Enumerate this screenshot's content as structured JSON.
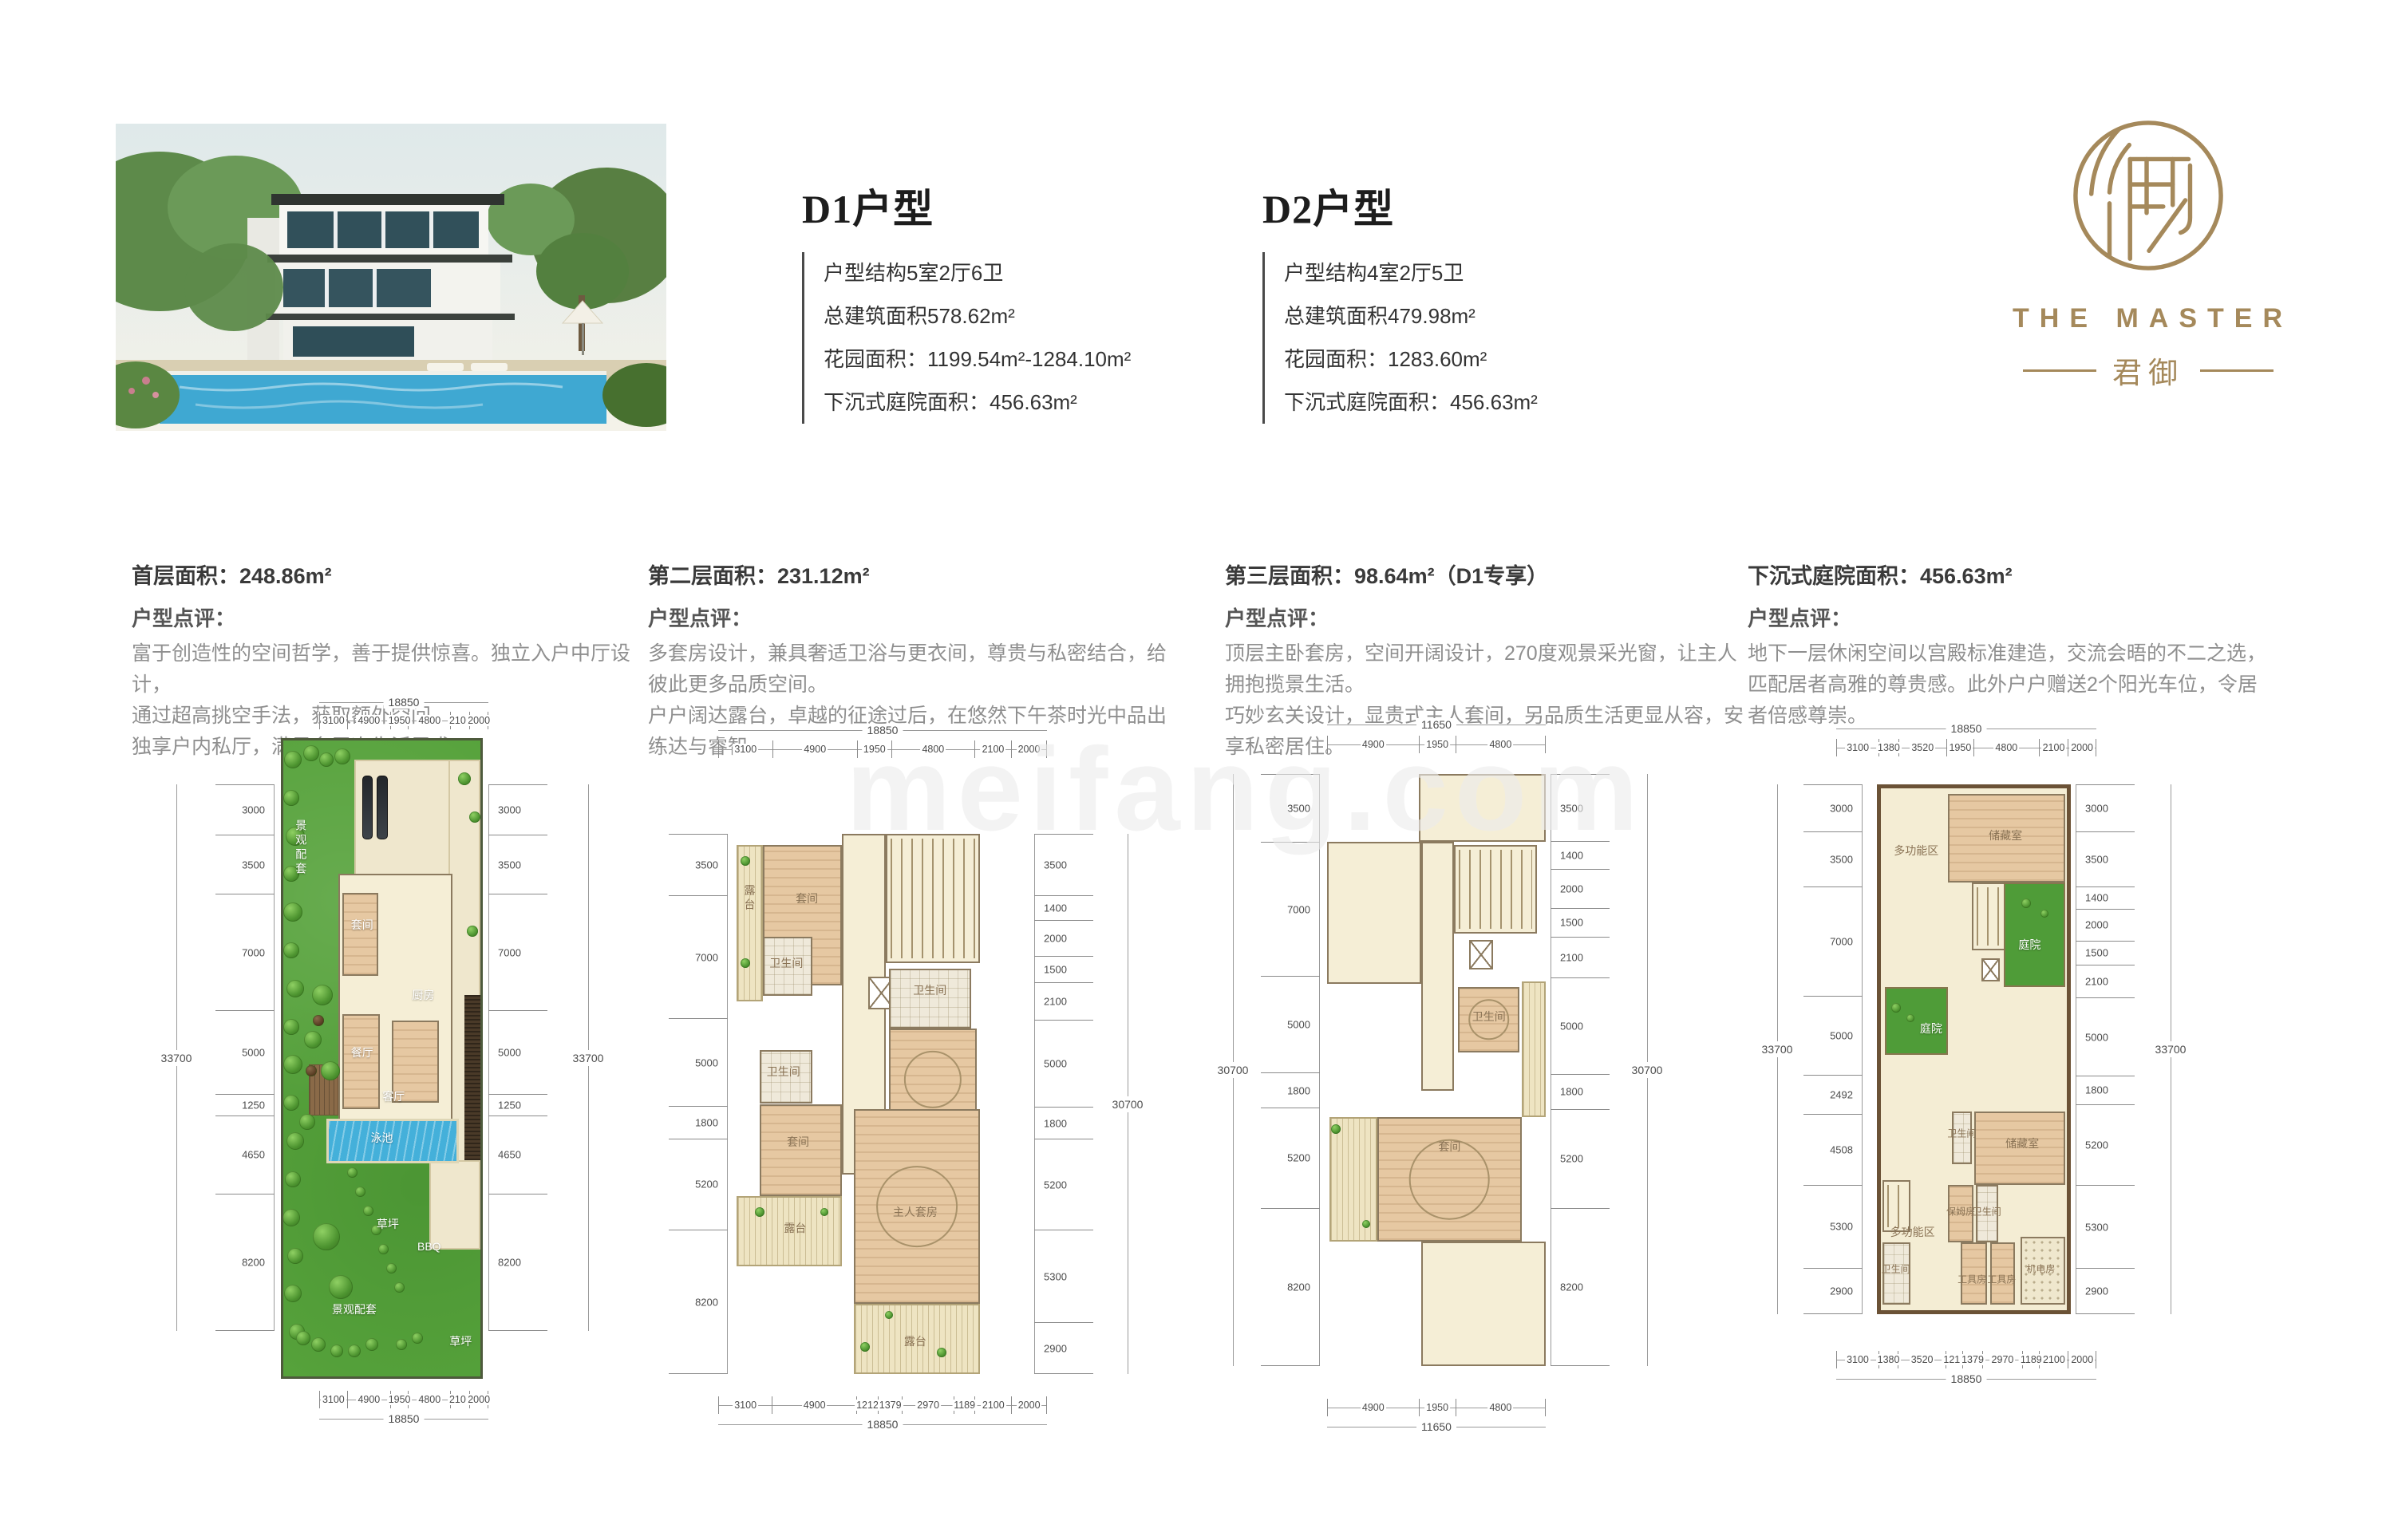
{
  "watermark": "meifang.com",
  "logo": {
    "name": "THE MASTER",
    "cn": "君御"
  },
  "units": [
    {
      "title": "D1户型",
      "lines": [
        "户型结构5室2厅6卫",
        "总建筑面积578.62m²",
        "花园面积：1199.54m²-1284.10m²",
        "下沉式庭院面积：456.63m²"
      ]
    },
    {
      "title": "D2户型",
      "lines": [
        "户型结构4室2厅5卫",
        "总建筑面积479.98m²",
        "花园面积：1283.60m²",
        "下沉式庭院面积：456.63m²"
      ]
    }
  ],
  "sections": [
    {
      "area": "首层面积：248.86m²",
      "comment_label": "户型点评：",
      "lines": [
        "富于创造性的空间哲学，善于提供惊喜。独立入户中厅设计，",
        "通过超高挑空手法，获取额外空间。",
        "独享户内私厅，满足多层次生活需求。"
      ]
    },
    {
      "area": "第二层面积：231.12m²",
      "comment_label": "户型点评：",
      "lines": [
        "多套房设计，兼具奢适卫浴与更衣间，尊贵与私密结合，给彼此更多品质空间。",
        "户户阔达露台，卓越的征途过后，在悠然下午茶时光中品出练达与睿智。"
      ]
    },
    {
      "area": "第三层面积：98.64m²（D1专享）",
      "comment_label": "户型点评：",
      "lines": [
        "顶层主卧套房，空间开阔设计，270度观景采光窗，让主人拥抱揽景生活。",
        "巧妙玄关设计，显贵式主人套间，另品质生活更显从容，安享私密居住。"
      ]
    },
    {
      "area": "下沉式庭院面积：456.63m²",
      "comment_label": "户型点评：",
      "lines": [
        "地下一层休闲空间以宫殿标准建造，交流会晤的不二之选，",
        "匹配居者高雅的尊贵感。此外户户赠送2个阳光车位，令居者倍感尊崇。"
      ]
    }
  ],
  "plans": [
    {
      "name": "首层",
      "top": {
        "total": "18850",
        "segments": [
          "3100",
          "4900",
          "1950",
          "4800",
          "2100",
          "2000"
        ]
      },
      "bottom": {
        "total": "18850",
        "segments": [
          "3100",
          "4900",
          "1950",
          "4800",
          "2100",
          "2000"
        ]
      },
      "left": {
        "total": "33700",
        "segments": [
          "3000",
          "3500",
          "7000",
          "5000",
          "1250",
          "4650",
          "8200"
        ]
      },
      "right": {
        "total": "33700",
        "segments": [
          "3000",
          "3500",
          "7000",
          "5000",
          "1250",
          "4650",
          "8200"
        ]
      },
      "rooms": [
        "景观配套",
        "套间",
        "厨房",
        "餐厅",
        "客厅",
        "泳池",
        "草坪",
        "BBQ",
        "景观配套",
        "草坪"
      ]
    },
    {
      "name": "第二层",
      "top": {
        "total": "18850",
        "segments": [
          "3100",
          "4900",
          "1950",
          "4800",
          "2100",
          "2000"
        ]
      },
      "bottom": {
        "total": "18850",
        "segments": [
          "3100",
          "4900",
          "1212",
          "1379",
          "2970",
          "1189",
          "2100",
          "2000"
        ]
      },
      "left": {
        "total": null,
        "segments": [
          "3500",
          "7000",
          "5000",
          "1800",
          "5200",
          "8200"
        ]
      },
      "right": {
        "total": "30700",
        "segments": [
          "3500",
          "1400",
          "2000",
          "1500",
          "2100",
          "5000",
          "1800",
          "5200",
          "5300",
          "2900"
        ]
      },
      "rooms": [
        "露台",
        "套间",
        "卫生间",
        "卫生间",
        "卫生间",
        "套间",
        "主人套房",
        "露台",
        "露台"
      ]
    },
    {
      "name": "第三层",
      "top": {
        "total": "11650",
        "segments": [
          "4900",
          "1950",
          "4800"
        ]
      },
      "bottom": {
        "total": "11650",
        "segments": [
          "4900",
          "1950",
          "4800"
        ]
      },
      "left": {
        "total": "30700",
        "segments": [
          "3500",
          "7000",
          "5000",
          "1800",
          "5200",
          "8200"
        ]
      },
      "right": {
        "total": "30700",
        "segments": [
          "3500",
          "1400",
          "2000",
          "1500",
          "2100",
          "5000",
          "1800",
          "5200",
          "8200"
        ]
      },
      "rooms": [
        "卫生间",
        "套间"
      ]
    },
    {
      "name": "下沉式庭院",
      "top": {
        "total": "18850",
        "segments": [
          "3100",
          "1380",
          "3520",
          "1950",
          "4800",
          "2100",
          "2000"
        ]
      },
      "bottom": {
        "total": "18850",
        "segments": [
          "3100",
          "1380",
          "3520",
          "1212",
          "1379",
          "2970",
          "1189",
          "2100",
          "2000"
        ]
      },
      "left": {
        "total": "33700",
        "segments": [
          "3000",
          "3500",
          "7000",
          "5000",
          "2492",
          "4508",
          "5300",
          "2900"
        ]
      },
      "right": {
        "total": "33700",
        "segments": [
          "3000",
          "3500",
          "1400",
          "2000",
          "1500",
          "2100",
          "5000",
          "1800",
          "5200",
          "5300",
          "2900"
        ]
      },
      "rooms": [
        "多功能区",
        "储藏室",
        "庭院",
        "庭院",
        "卫生间",
        "储藏室",
        "保姆房",
        "卫生间",
        "机电房",
        "多功能区",
        "卫生间",
        "工具房",
        "工具房"
      ]
    }
  ]
}
